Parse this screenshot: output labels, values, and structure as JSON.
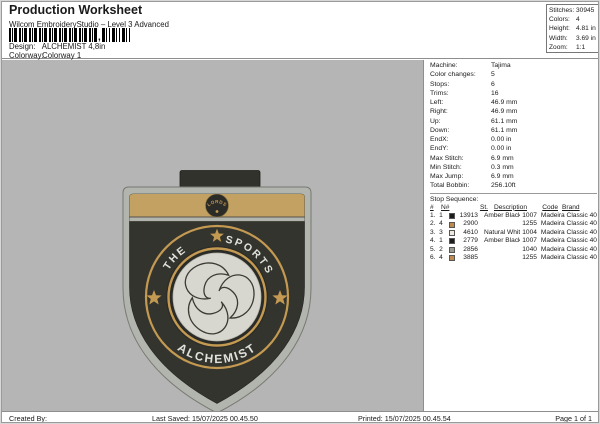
{
  "header": {
    "title": "Production Worksheet",
    "subtitle": "Wilcom EmbroideryStudio – Level 3 Advanced",
    "design_label": "Design:",
    "design_value": "ALCHEMIST 4,8in",
    "colorway_label": "Colorway:",
    "colorway_value": "Colorway 1"
  },
  "summary": {
    "rows": [
      {
        "label": "Stitches:",
        "value": "30945"
      },
      {
        "label": "Colors:",
        "value": "4"
      },
      {
        "label": "Height:",
        "value": "4.81 in"
      },
      {
        "label": "Width:",
        "value": "3.69 in"
      },
      {
        "label": "Zoom:",
        "value": "1:1"
      }
    ]
  },
  "machine": {
    "rows": [
      {
        "label": "Machine:",
        "value": "Tajima"
      },
      {
        "label": "Color changes:",
        "value": "5"
      },
      {
        "label": "Stops:",
        "value": "6"
      },
      {
        "label": "Trims:",
        "value": "16"
      },
      {
        "label": "Left:",
        "value": "46.9 mm"
      },
      {
        "label": "Right:",
        "value": "46.9 mm"
      },
      {
        "label": "Up:",
        "value": "61.1 mm"
      },
      {
        "label": "Down:",
        "value": "61.1 mm"
      },
      {
        "label": "EndX:",
        "value": "0.00 in"
      },
      {
        "label": "EndY:",
        "value": "0.00 in"
      },
      {
        "label": "Max Stitch:",
        "value": "6.9 mm"
      },
      {
        "label": "Min Stitch:",
        "value": "0.3 mm"
      },
      {
        "label": "Max Jump:",
        "value": "6.9 mm"
      },
      {
        "label": "Total Bobbin:",
        "value": "256.10ft"
      }
    ]
  },
  "stop_sequence": {
    "title": "Stop Sequence:",
    "columns": [
      "#",
      "N#",
      "St.",
      "Description",
      "Code",
      "Brand"
    ],
    "rows": [
      {
        "num": "1.",
        "n": "1",
        "color": "#1c1c1c",
        "st": "13913",
        "description": "Amber Black",
        "code": "1007",
        "brand": "Madeira Classic 40"
      },
      {
        "num": "2.",
        "n": "4",
        "color": "#bd8a50",
        "st": "2900",
        "description": "",
        "code": "1255",
        "brand": "Madeira Classic 40"
      },
      {
        "num": "3.",
        "n": "3",
        "color": "#eceadf",
        "st": "4610",
        "description": "Natural White",
        "code": "1004",
        "brand": "Madeira Classic 40"
      },
      {
        "num": "4.",
        "n": "1",
        "color": "#1c1c1c",
        "st": "2779",
        "description": "Amber Black",
        "code": "1007",
        "brand": "Madeira Classic 40"
      },
      {
        "num": "5.",
        "n": "2",
        "color": "#9a9a90",
        "st": "2856",
        "description": "",
        "code": "1040",
        "brand": "Madeira Classic 40"
      },
      {
        "num": "6.",
        "n": "4",
        "color": "#bd8a50",
        "st": "3885",
        "description": "",
        "code": "1255",
        "brand": "Madeira Classic 40"
      }
    ]
  },
  "footer": {
    "created_by": "Created By:",
    "last_saved": "Last Saved: 15/07/2025 00.45.50",
    "printed": "Printed: 15/07/2025 00.45.54",
    "page": "Page 1 of 1"
  },
  "badge": {
    "band_text": "LORDS",
    "arc_top_left": "THE",
    "arc_top_right": "SPORTS",
    "arc_bottom": "ALCHEMIST",
    "colors": {
      "preview_bg": "#b5b5b5",
      "body": "#34342e",
      "body_dark": "#2b2b27",
      "border_gray": "#b2b4ae",
      "band_tan": "#c2a162",
      "gold": "#c49a52",
      "ball": "#d7d7cf",
      "text_white": "#e2e2dc",
      "tab": "#32322d"
    }
  }
}
